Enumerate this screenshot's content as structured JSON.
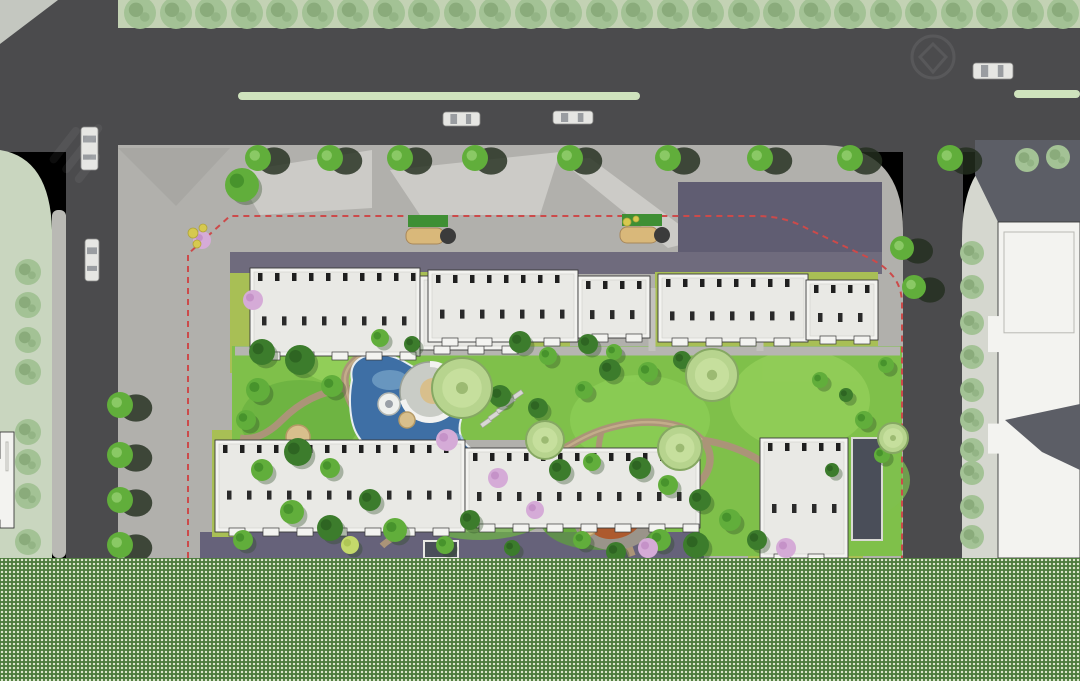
{
  "map": {
    "kind": "residential-landscape-masterplan-top-view",
    "palette": {
      "road": "#4b4b4d",
      "corner_wedge": "#c4c7c0",
      "lane_stripe": "#cfe3bd",
      "top_verge": "#c3d2b4",
      "left_verge": "#c9d6bf",
      "side_strip": "#b9b9b4",
      "plaza_gray": "#b1b0ac",
      "plaza_dark_wedge": "#a8a7a3",
      "plaza_light": "#cccbc7",
      "paving_purple": "#6f6b7d",
      "paving_purple_dark": "#605d72",
      "paving_purple_south": "#66627a",
      "lawn_bright": "#7fc04a",
      "lawn_olive": "#a8bf55",
      "neighbor_sidewalk": "#d5d7cf",
      "building_white": "#f3f3f0",
      "building_inner": "#e9e9e5",
      "building_line": "#3a3a3a",
      "building_window": "#1f1f1f",
      "building_shadow": "#5c5e66",
      "tower_dark": "#4a4e59",
      "water_deep": "#3e6fa5",
      "water_light": "#7aa6cb",
      "shore_light": "#e8eef2",
      "path_tan": "#ab9478",
      "path_tan_light": "#c9b28e",
      "path_gray": "#b6b5b1",
      "spiral_gray": "#c9ccc6",
      "deck_tan": "#d8bf8c",
      "playground_base": "#9a948a",
      "playground_rust": "#ad5a2e",
      "playground_orange": "#c8793f",
      "playground_dark": "#7a3a1c",
      "hedge_green": "#3f8f34",
      "bench_tan": "#d9b87a",
      "shrub_yellow": "#d6c94f",
      "blossom_pink": "#d5abd7",
      "boundary_red": "#cc4a4a",
      "car_body": "#e6e6e3",
      "car_glass": "#9a9da1",
      "tree_bright": "#61ae3b",
      "tree_dark": "#3c7c2c",
      "tree_pale": "#a6c987",
      "tree_yellow": "#c4d96b",
      "tree_street": "#a3c295",
      "tree_shadow": "#232e1e",
      "band_green": "#4c7b3c",
      "band_dot": "#dfe9cf",
      "watermark": "#ffffff"
    },
    "features": {
      "lane_stripes": [
        {
          "x": 238,
          "y": 92,
          "w": 402,
          "h": 8
        },
        {
          "x": 1014,
          "y": 90,
          "w": 66,
          "h": 8
        }
      ],
      "cars": [
        {
          "x": 443,
          "y": 112,
          "w": 37,
          "h": 14,
          "dir": "h"
        },
        {
          "x": 553,
          "y": 111,
          "w": 40,
          "h": 13,
          "dir": "h"
        },
        {
          "x": 973,
          "y": 63,
          "w": 40,
          "h": 16,
          "dir": "h"
        },
        {
          "x": 81,
          "y": 127,
          "w": 17,
          "h": 43,
          "dir": "v"
        },
        {
          "x": 85,
          "y": 239,
          "w": 14,
          "h": 42,
          "dir": "v"
        }
      ],
      "top_verge_trees": {
        "y": 13,
        "r": 16,
        "xs": [
          140,
          176,
          211,
          247,
          282,
          318,
          353,
          389,
          424,
          460,
          495,
          531,
          566,
          602,
          637,
          673,
          708,
          744,
          779,
          815,
          850,
          886,
          921,
          957,
          992,
          1028,
          1063
        ]
      },
      "north_row_trees": {
        "y": 158,
        "r": 13,
        "xs": [
          258,
          330,
          400,
          475,
          570,
          668,
          760,
          850,
          950
        ]
      },
      "east_corner_trees": [
        {
          "x": 902,
          "y": 248,
          "r": 12
        },
        {
          "x": 914,
          "y": 287,
          "r": 12
        }
      ],
      "west_col_trees": {
        "x": 120,
        "r": 13,
        "ys": [
          405,
          455,
          500,
          545
        ]
      },
      "left_verge_trees": {
        "x": 28,
        "r": 13,
        "ys": [
          272,
          305,
          340,
          372,
          432,
          462,
          496,
          542
        ]
      },
      "neighbor_col_trees": {
        "x": 972,
        "r": 12,
        "ys": [
          253,
          287,
          323,
          357,
          390,
          420,
          450,
          473,
          507,
          537
        ]
      },
      "neighbor_corner_trees": [
        {
          "x": 1027,
          "y": 160,
          "r": 12
        },
        {
          "x": 1058,
          "y": 157,
          "r": 12
        }
      ],
      "garden_trees": [
        [
          242,
          185,
          17,
          "bright"
        ],
        [
          262,
          352,
          13,
          "dark"
        ],
        [
          300,
          360,
          15,
          "dark"
        ],
        [
          332,
          386,
          11,
          "bright"
        ],
        [
          258,
          390,
          12,
          "bright"
        ],
        [
          246,
          420,
          10,
          "bright"
        ],
        [
          298,
          452,
          14,
          "dark"
        ],
        [
          262,
          470,
          11,
          "bright"
        ],
        [
          330,
          468,
          10,
          "bright"
        ],
        [
          292,
          512,
          12,
          "bright"
        ],
        [
          330,
          528,
          13,
          "dark"
        ],
        [
          243,
          540,
          10,
          "bright"
        ],
        [
          370,
          500,
          11,
          "dark"
        ],
        [
          395,
          530,
          12,
          "bright"
        ],
        [
          350,
          545,
          9,
          "yellow"
        ],
        [
          380,
          338,
          9,
          "bright"
        ],
        [
          412,
          344,
          8,
          "dark"
        ],
        [
          520,
          342,
          11,
          "dark"
        ],
        [
          548,
          356,
          9,
          "bright"
        ],
        [
          588,
          344,
          10,
          "dark"
        ],
        [
          614,
          352,
          8,
          "bright"
        ],
        [
          500,
          396,
          11,
          "dark"
        ],
        [
          538,
          408,
          10,
          "dark"
        ],
        [
          584,
          390,
          9,
          "bright"
        ],
        [
          610,
          370,
          11,
          "dark"
        ],
        [
          648,
          372,
          10,
          "bright"
        ],
        [
          682,
          360,
          9,
          "dark"
        ],
        [
          560,
          470,
          11,
          "dark"
        ],
        [
          592,
          462,
          9,
          "bright"
        ],
        [
          640,
          468,
          11,
          "dark"
        ],
        [
          668,
          485,
          10,
          "bright"
        ],
        [
          700,
          500,
          11,
          "dark"
        ],
        [
          582,
          540,
          9,
          "bright"
        ],
        [
          616,
          552,
          10,
          "dark"
        ],
        [
          660,
          540,
          11,
          "bright"
        ],
        [
          696,
          545,
          13,
          "dark"
        ],
        [
          730,
          520,
          11,
          "bright"
        ],
        [
          757,
          540,
          10,
          "dark"
        ],
        [
          820,
          380,
          8,
          "bright"
        ],
        [
          846,
          395,
          7,
          "dark"
        ],
        [
          864,
          420,
          9,
          "bright"
        ],
        [
          882,
          455,
          8,
          "bright"
        ],
        [
          832,
          470,
          7,
          "dark"
        ],
        [
          886,
          365,
          8,
          "bright"
        ],
        [
          470,
          520,
          10,
          "dark"
        ],
        [
          445,
          545,
          9,
          "bright"
        ],
        [
          512,
          548,
          8,
          "dark"
        ]
      ],
      "ring_trees": [
        [
          462,
          388,
          30
        ],
        [
          545,
          440,
          19
        ],
        [
          712,
          375,
          26
        ],
        [
          680,
          448,
          22
        ],
        [
          893,
          438,
          15
        ]
      ],
      "blossom_trees": [
        [
          202,
          240,
          9
        ],
        [
          253,
          300,
          10
        ],
        [
          447,
          440,
          11
        ],
        [
          498,
          478,
          10
        ],
        [
          535,
          510,
          9
        ],
        [
          648,
          548,
          10
        ],
        [
          786,
          548,
          10
        ]
      ],
      "yellow_shrubs": [
        [
          193,
          233,
          5
        ],
        [
          203,
          228,
          4
        ],
        [
          197,
          244,
          4
        ],
        [
          627,
          222,
          4
        ],
        [
          636,
          219,
          3
        ]
      ],
      "tan_decks": [
        [
          298,
          437,
          12
        ],
        [
          407,
          420,
          8
        ],
        [
          588,
          528,
          8
        ]
      ],
      "stepping_stones": [
        [
          480,
          424
        ],
        [
          488,
          417
        ],
        [
          496,
          410
        ],
        [
          504,
          403
        ],
        [
          512,
          396
        ]
      ],
      "pergolas": [
        {
          "x": 408,
          "y": 215
        },
        {
          "x": 622,
          "y": 214
        }
      ],
      "buildings": [
        {
          "name": "north-block-a",
          "kind": "detail",
          "parts": [
            [
              250,
              268,
              170,
              88
            ],
            [
              420,
              276,
              100,
              74
            ]
          ]
        },
        {
          "name": "north-block-b",
          "kind": "detail",
          "parts": [
            [
              428,
              270,
              150,
              72
            ],
            [
              578,
              276,
              72,
              62
            ]
          ]
        },
        {
          "name": "north-block-c",
          "kind": "detail",
          "parts": [
            [
              658,
              274,
              150,
              68
            ],
            [
              806,
              280,
              72,
              60
            ]
          ]
        },
        {
          "name": "south-block-d",
          "kind": "detail",
          "parts": [
            [
              215,
              440,
              250,
              92
            ],
            [
              465,
              448,
              235,
              80
            ]
          ]
        },
        {
          "name": "south-block-e",
          "kind": "detail",
          "parts": [
            [
              760,
              438,
              88,
              120
            ]
          ]
        },
        {
          "name": "west-sliver",
          "kind": "plain",
          "parts": [
            [
              0,
              432,
              14,
              96
            ]
          ]
        },
        {
          "name": "neighbor-tower",
          "kind": "plain",
          "parts": [
            [
              998,
              222,
              82,
              336
            ]
          ]
        }
      ]
    }
  }
}
